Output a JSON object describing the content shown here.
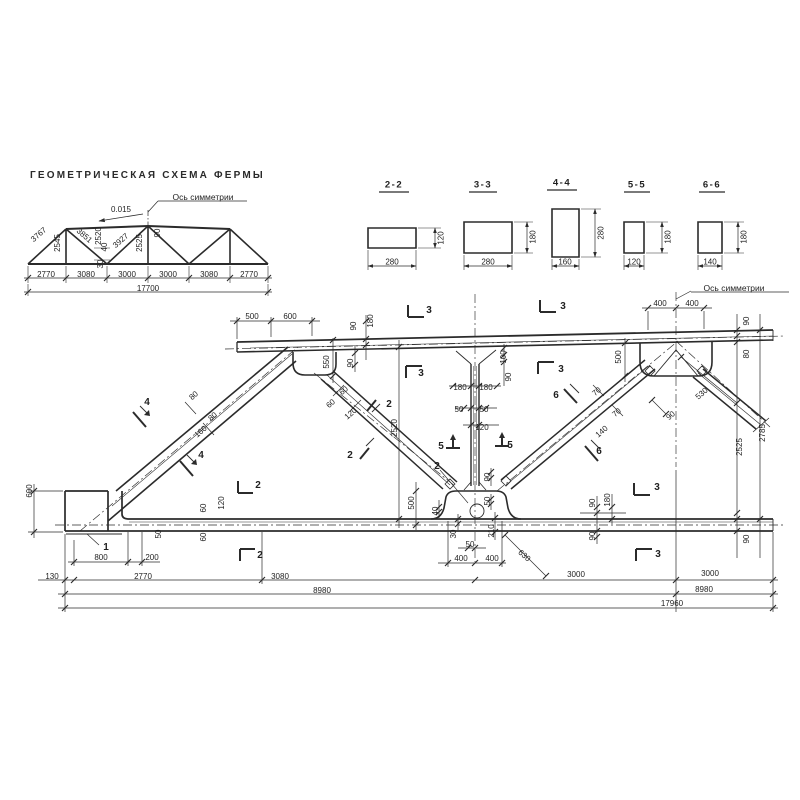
{
  "title": "ГЕОМЕТРИЧЕСКАЯ СХЕМА ФЕРМЫ",
  "sections": [
    {
      "name": "2-2",
      "width": "280",
      "height": "120"
    },
    {
      "name": "3-3",
      "width": "280",
      "height": "180"
    },
    {
      "name": "4-4",
      "width": "160",
      "height": "280"
    },
    {
      "name": "5-5",
      "width": "120",
      "height": "180"
    },
    {
      "name": "6-6",
      "width": "140",
      "height": "180"
    }
  ],
  "labels": [
    {
      "t": "Ось симметрии",
      "n": "symmetry-axis-label-schema",
      "x": 203,
      "y": 197,
      "s": 8.5
    },
    {
      "t": "0.015",
      "n": "slope-value",
      "x": 121,
      "y": 210
    },
    {
      "t": "3767",
      "x": 39,
      "y": 235,
      "r": -41
    },
    {
      "t": "2545",
      "x": 58,
      "y": 243,
      "r": -90
    },
    {
      "t": "3851",
      "x": 84,
      "y": 236,
      "r": 41
    },
    {
      "t": "2520",
      "x": 99,
      "y": 236,
      "r": -90
    },
    {
      "t": "40",
      "x": 105,
      "y": 247,
      "r": -90
    },
    {
      "t": "30",
      "x": 101,
      "y": 264,
      "r": -90
    },
    {
      "t": "3927",
      "x": 121,
      "y": 241,
      "r": -41
    },
    {
      "t": "2525",
      "x": 140,
      "y": 243,
      "r": -90
    },
    {
      "t": "90",
      "x": 158,
      "y": 233,
      "r": -90
    },
    {
      "t": "2770",
      "x": 46,
      "y": 275
    },
    {
      "t": "3080",
      "x": 86,
      "y": 275
    },
    {
      "t": "3000",
      "x": 127,
      "y": 275
    },
    {
      "t": "3000",
      "x": 168,
      "y": 275
    },
    {
      "t": "3080",
      "x": 209,
      "y": 275
    },
    {
      "t": "2770",
      "x": 249,
      "y": 275
    },
    {
      "t": "17700",
      "n": "schema-total-length",
      "x": 148,
      "y": 289
    },
    {
      "t": "Ось симметрии",
      "n": "symmetry-axis-label-main",
      "x": 734,
      "y": 288,
      "s": 8.5
    },
    {
      "t": "500",
      "x": 252,
      "y": 317
    },
    {
      "t": "600",
      "x": 290,
      "y": 317
    },
    {
      "t": "90",
      "x": 354,
      "y": 326,
      "r": -90
    },
    {
      "t": "180",
      "x": 371,
      "y": 321,
      "r": -90
    },
    {
      "t": "3",
      "n": "section-mark",
      "x": 429,
      "y": 311,
      "s": 10
    },
    {
      "t": "3",
      "n": "section-mark",
      "x": 563,
      "y": 307,
      "s": 10
    },
    {
      "t": "3",
      "n": "section-mark",
      "x": 421,
      "y": 374,
      "s": 10
    },
    {
      "t": "3",
      "n": "section-mark",
      "x": 561,
      "y": 370,
      "s": 10
    },
    {
      "t": "400",
      "x": 660,
      "y": 304
    },
    {
      "t": "400",
      "x": 692,
      "y": 304
    },
    {
      "t": "90",
      "x": 747,
      "y": 321,
      "r": -90
    },
    {
      "t": "80",
      "x": 747,
      "y": 354,
      "r": -90
    },
    {
      "t": "2525",
      "x": 740,
      "y": 447,
      "r": -90
    },
    {
      "t": "2785",
      "x": 763,
      "y": 433,
      "r": -90
    },
    {
      "t": "550",
      "x": 327,
      "y": 362,
      "r": -90
    },
    {
      "t": "90",
      "x": 351,
      "y": 363,
      "r": -90
    },
    {
      "t": "4",
      "n": "section-mark",
      "x": 147,
      "y": 403,
      "s": 10
    },
    {
      "t": "4",
      "n": "section-mark",
      "x": 201,
      "y": 456,
      "s": 10
    },
    {
      "t": "80",
      "x": 194,
      "y": 396,
      "r": -41
    },
    {
      "t": "80",
      "x": 213,
      "y": 417,
      "r": -41
    },
    {
      "t": "160",
      "x": 201,
      "y": 432,
      "r": -41
    },
    {
      "t": "60",
      "x": 344,
      "y": 391,
      "r": -41
    },
    {
      "t": "60",
      "x": 331,
      "y": 404,
      "r": -41
    },
    {
      "t": "120",
      "x": 351,
      "y": 414,
      "r": -41
    },
    {
      "t": "2520",
      "x": 395,
      "y": 428,
      "r": -90
    },
    {
      "t": "2",
      "n": "section-mark",
      "x": 389,
      "y": 405,
      "s": 10
    },
    {
      "t": "2",
      "n": "section-mark",
      "x": 350,
      "y": 456,
      "s": 10
    },
    {
      "t": "100",
      "x": 504,
      "y": 357,
      "r": -90
    },
    {
      "t": "90",
      "x": 509,
      "y": 377,
      "r": -90
    },
    {
      "t": "180",
      "x": 460,
      "y": 388
    },
    {
      "t": "180",
      "x": 486,
      "y": 388
    },
    {
      "t": "50",
      "x": 459,
      "y": 410
    },
    {
      "t": "50",
      "x": 484,
      "y": 410
    },
    {
      "t": "120",
      "x": 482,
      "y": 428
    },
    {
      "t": "5",
      "n": "section-mark",
      "x": 441,
      "y": 447,
      "s": 10
    },
    {
      "t": "5",
      "n": "section-mark",
      "x": 510,
      "y": 446,
      "s": 10
    },
    {
      "t": "500",
      "x": 619,
      "y": 357,
      "r": -90
    },
    {
      "t": "6",
      "n": "section-mark",
      "x": 556,
      "y": 396,
      "s": 10
    },
    {
      "t": "6",
      "n": "section-mark",
      "x": 599,
      "y": 452,
      "s": 10
    },
    {
      "t": "70",
      "x": 597,
      "y": 392,
      "r": -41
    },
    {
      "t": "70",
      "x": 617,
      "y": 413,
      "r": -41
    },
    {
      "t": "140",
      "x": 602,
      "y": 432,
      "r": -41
    },
    {
      "t": "530",
      "x": 702,
      "y": 394,
      "r": -41
    },
    {
      "t": "90",
      "x": 671,
      "y": 416,
      "r": -41
    },
    {
      "t": "2",
      "n": "detail-mark",
      "x": 437,
      "y": 467,
      "s": 10
    },
    {
      "t": "500",
      "x": 412,
      "y": 503,
      "r": -90
    },
    {
      "t": "90",
      "x": 488,
      "y": 477,
      "r": -90
    },
    {
      "t": "50",
      "x": 488,
      "y": 501,
      "r": -90
    },
    {
      "t": "40",
      "x": 436,
      "y": 511,
      "r": -90
    },
    {
      "t": "30",
      "x": 454,
      "y": 534,
      "r": -90
    },
    {
      "t": "210",
      "x": 492,
      "y": 531,
      "r": -90
    },
    {
      "t": "50",
      "x": 470,
      "y": 545
    },
    {
      "t": "90",
      "x": 593,
      "y": 503,
      "r": -90
    },
    {
      "t": "180",
      "x": 608,
      "y": 500,
      "r": -90
    },
    {
      "t": "90",
      "x": 593,
      "y": 536,
      "r": -90
    },
    {
      "t": "3",
      "n": "section-mark",
      "x": 657,
      "y": 488,
      "s": 10
    },
    {
      "t": "3",
      "n": "section-mark",
      "x": 658,
      "y": 555,
      "s": 10
    },
    {
      "t": "90",
      "x": 747,
      "y": 539,
      "r": -90
    },
    {
      "t": "600",
      "x": 30,
      "y": 491,
      "r": -90
    },
    {
      "t": "1",
      "n": "detail-mark",
      "x": 106,
      "y": 548,
      "s": 10
    },
    {
      "t": "130",
      "x": 52,
      "y": 577
    },
    {
      "t": "800",
      "x": 101,
      "y": 558
    },
    {
      "t": "200",
      "x": 152,
      "y": 558
    },
    {
      "t": "2",
      "n": "section-mark",
      "x": 258,
      "y": 486,
      "s": 10
    },
    {
      "t": "2",
      "n": "section-mark",
      "x": 260,
      "y": 556,
      "s": 10
    },
    {
      "t": "50",
      "x": 159,
      "y": 534,
      "r": -90
    },
    {
      "t": "60",
      "x": 204,
      "y": 508,
      "r": -90
    },
    {
      "t": "120",
      "x": 222,
      "y": 503,
      "r": -90
    },
    {
      "t": "60",
      "x": 204,
      "y": 537,
      "r": -90
    },
    {
      "t": "400",
      "x": 461,
      "y": 559
    },
    {
      "t": "400",
      "x": 492,
      "y": 559
    },
    {
      "t": "630",
      "x": 524,
      "y": 556,
      "r": 41
    },
    {
      "t": "2770",
      "x": 143,
      "y": 577
    },
    {
      "t": "3080",
      "x": 280,
      "y": 577
    },
    {
      "t": "3000",
      "x": 576,
      "y": 575
    },
    {
      "t": "3000",
      "x": 710,
      "y": 574
    },
    {
      "t": "8980",
      "x": 322,
      "y": 591
    },
    {
      "t": "8980",
      "x": 704,
      "y": 590
    },
    {
      "t": "17960",
      "n": "total-length",
      "x": 672,
      "y": 604
    }
  ]
}
